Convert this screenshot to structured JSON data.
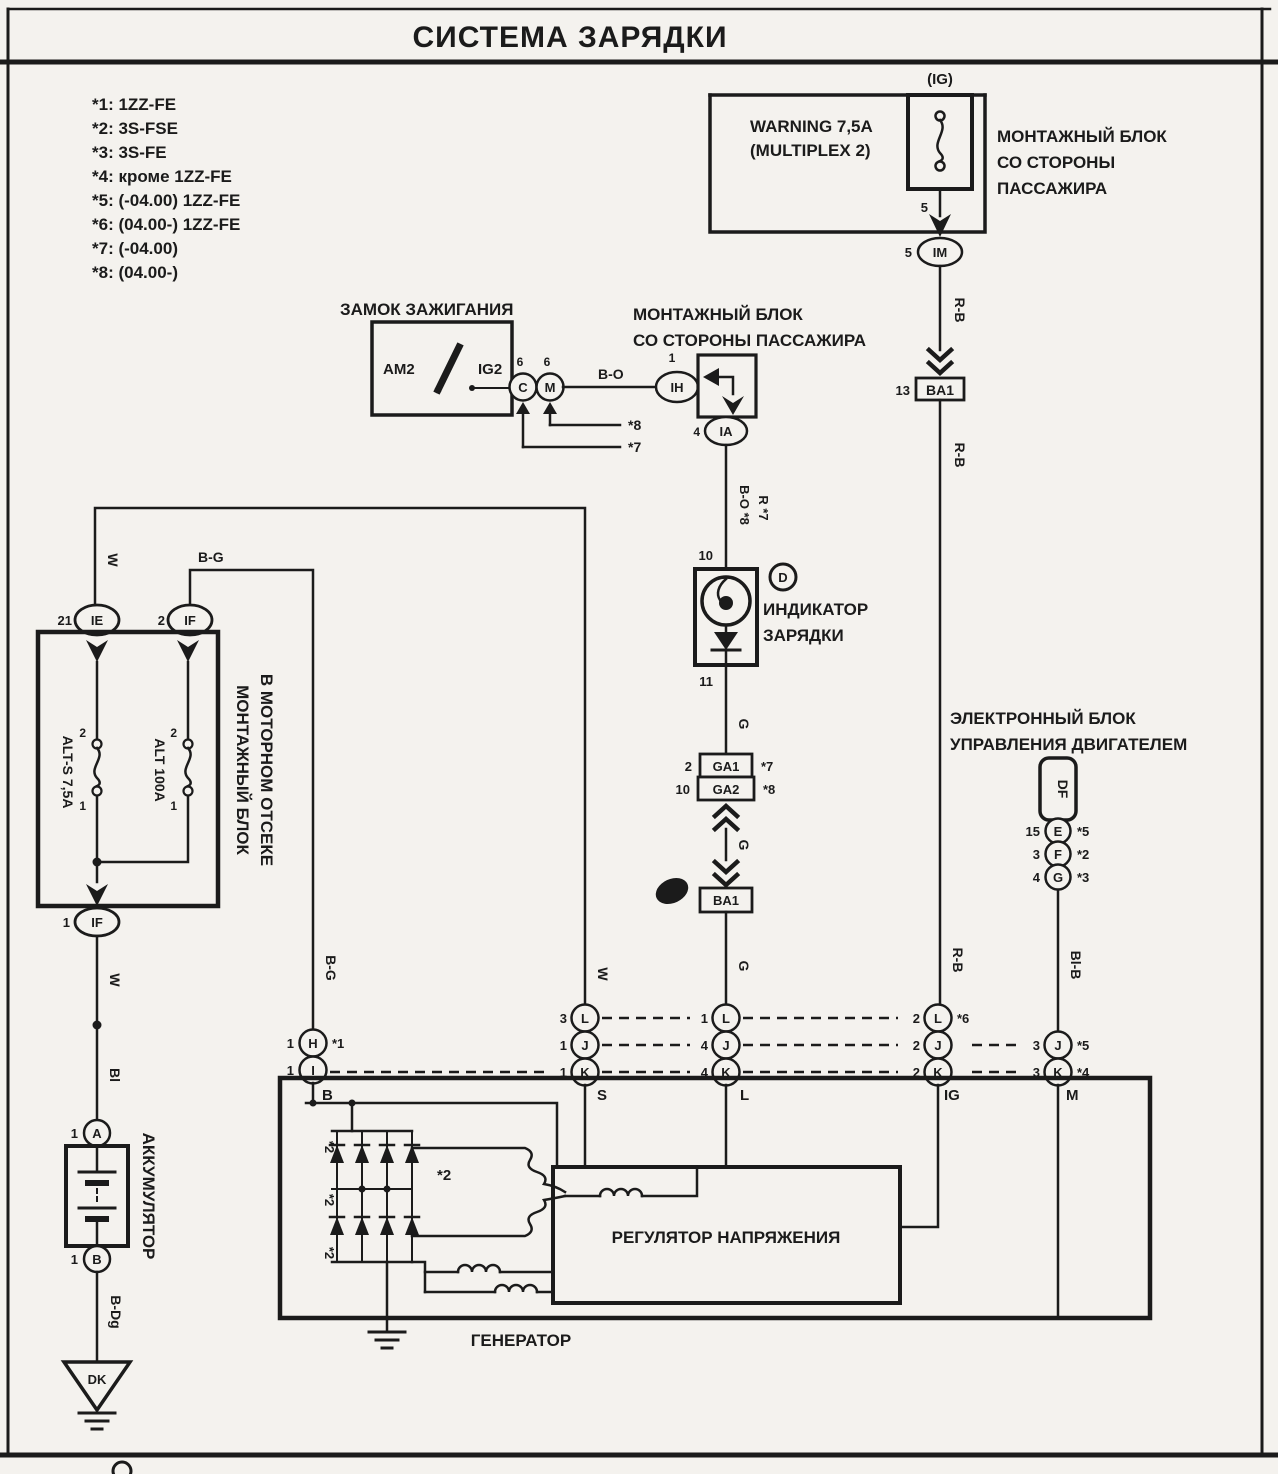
{
  "title": "СИСТЕМА ЗАРЯДКИ",
  "legend": {
    "items": [
      "*1: 1ZZ-FE",
      "*2: 3S-FSE",
      "*3: 3S-FE",
      "*4: кроме 1ZZ-FE",
      "*5: (-04.00) 1ZZ-FE",
      "*6: (04.00-) 1ZZ-FE",
      "*7: (-04.00)",
      "*8: (04.00-)"
    ]
  },
  "wires": {
    "rb": "R-B",
    "bo": "B-O",
    "w": "W",
    "bg": "B-G",
    "g": "G",
    "bl": "Bl",
    "blb": "Bl-B",
    "bdg": "B-Dg",
    "bo_note": "B-O *8",
    "r_note": "R *7"
  },
  "top_right": {
    "ig_tag": "(IG)",
    "fuse_line1": "WARNING 7,5A",
    "fuse_line2": "(MULTIPLEX 2)",
    "block_line1": "МОНТАЖНЫЙ БЛОК",
    "block_line2": "СО СТОРОНЫ",
    "block_line3": "ПАССАЖИРА",
    "pin_fuse": "5",
    "pin_conn": "5",
    "connector": "IM",
    "ba1": "BA1",
    "ba1_pin": "13"
  },
  "ignition": {
    "title": "ЗАМОК ЗАЖИГАНИЯ",
    "am2": "AM2",
    "ig2": "IG2",
    "conn_c": "C",
    "conn_m": "M",
    "pin_c": "6",
    "pin_m": "6",
    "note_c": "*7",
    "note_m": "*8"
  },
  "passenger_block": {
    "line1": "МОНТАЖНЫЙ БЛОК",
    "line2": "СО СТОРОНЫ ПАССАЖИРА",
    "conn_ih": "IH",
    "pin_ih": "1",
    "conn_ia": "IA",
    "pin_ia": "4"
  },
  "indicator": {
    "pin_top": "10",
    "pin_bottom": "11",
    "circle_d": "D",
    "line1": "ИНДИКАТОР",
    "line2": "ЗАРЯДКИ"
  },
  "ga": {
    "ga1": "GA1",
    "ga1_pin": "2",
    "ga1_note": "*7",
    "ga2": "GA2",
    "ga2_pin": "10",
    "ga2_note": "*8",
    "ba1": "BA1"
  },
  "ecu": {
    "line1": "ЭЛЕКТРОННЫЙ БЛОК",
    "line2": "УПРАВЛЕНИЯ ДВИГАТЕЛЕМ",
    "df": "DF",
    "rows": [
      {
        "pin": "15",
        "conn": "E",
        "note": "*5"
      },
      {
        "pin": "3",
        "conn": "F",
        "note": "*2"
      },
      {
        "pin": "4",
        "conn": "G",
        "note": "*3"
      }
    ]
  },
  "engine_block": {
    "line1": "МОНТАЖНЫЙ БЛОК",
    "line2": "В МОТОРНОМ ОТСЕКЕ",
    "fuse1": "ALT-S 7,5A",
    "fuse2": "ALT 100A",
    "fuse1_pin_top": "2",
    "fuse1_pin_bot": "1",
    "fuse2_pin_top": "2",
    "fuse2_pin_bot": "1",
    "conn_ie": "IE",
    "pin_ie": "21",
    "conn_if_top": "IF",
    "pin_if_top": "2",
    "conn_if_bot": "IF",
    "pin_if_bot": "1"
  },
  "battery": {
    "label": "АККУМУЛЯТОР",
    "conn_a": "A",
    "pin_a": "1",
    "conn_b": "B",
    "pin_b": "1",
    "ground": "DK"
  },
  "junction_row": {
    "b": {
      "pin_h": "1",
      "h": "H",
      "note_h": "*1",
      "pin_i": "1",
      "i": "I"
    },
    "s": {
      "pin_l": "3",
      "l": "L",
      "pin_j": "1",
      "j": "J",
      "pin_k": "1",
      "k": "K"
    },
    "l": {
      "pin_l": "1",
      "l": "L",
      "pin_j": "4",
      "j": "J",
      "pin_k": "4",
      "k": "K"
    },
    "ig": {
      "pin_l": "2",
      "l": "L",
      "note_l": "*6",
      "pin_j": "2",
      "j": "J",
      "pin_k": "2",
      "k": "K"
    },
    "m": {
      "pin_j": "3",
      "j": "J",
      "note_j": "*5",
      "pin_k": "3",
      "k": "K",
      "note_k": "*4"
    }
  },
  "generator": {
    "label": "ГЕНЕРАТОР",
    "regulator": "РЕГУЛЯТОР НАПРЯЖЕНИЯ",
    "terminals": [
      "B",
      "S",
      "L",
      "IG",
      "M"
    ],
    "stator_note": "*2",
    "rectifier_notes": [
      "*2",
      "*2",
      "*2"
    ]
  }
}
